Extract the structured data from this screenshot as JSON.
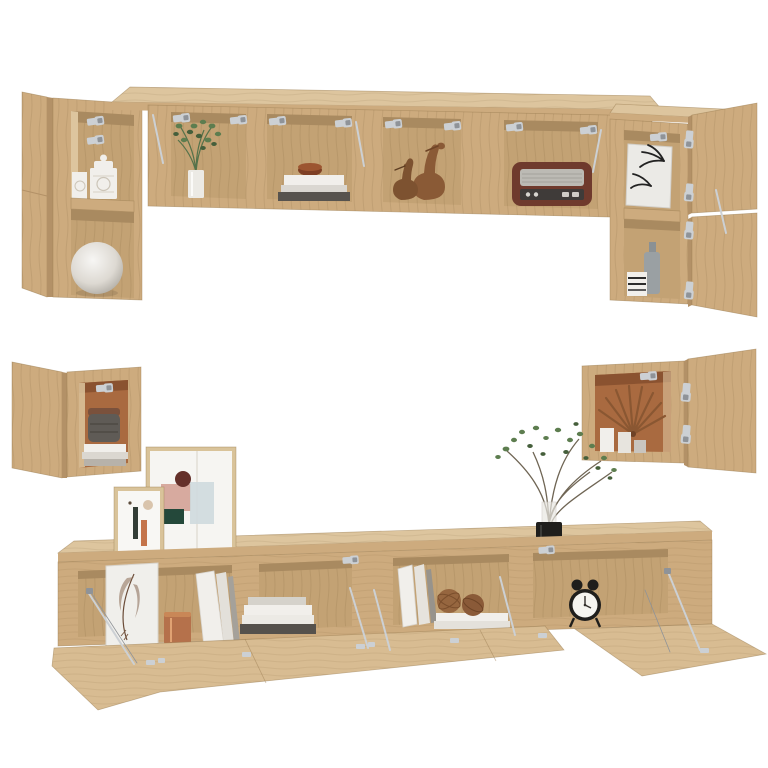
{
  "scene": {
    "description": "Product photo of a six-piece wall-mounted TV cabinet set in sonoma oak with open flap doors, silver hinges and lid stays, styled with decorative accessories, on a plain white background",
    "set_pieces": [
      {
        "name": "top-left-wall-cabinet",
        "decor": [
          "patterned-ceramic-jars",
          "white-sphere-vase"
        ]
      },
      {
        "name": "top-long-wall-cabinet",
        "decor": [
          "green-plant-in-vase",
          "book-stack-with-bowl",
          "wooden-bird-figurines",
          "vintage-radio"
        ]
      },
      {
        "name": "top-right-wall-cabinet",
        "decor": [
          "palm-leaf-print",
          "grey-bottle-vase",
          "striped-box"
        ]
      },
      {
        "name": "mid-left-wall-cube-cabinet",
        "decor": [
          "woven-basket",
          "magazine-stack"
        ]
      },
      {
        "name": "mid-right-wall-cube-cabinet",
        "decor": [
          "dried-palm-fan",
          "white-vases"
        ]
      },
      {
        "name": "tv-bench",
        "decor_on_top": [
          "abstract-art-frame-large",
          "abstract-art-frame-small",
          "plant-in-black-pot"
        ],
        "decor_inside": [
          "feather-print-panel",
          "copper-pot",
          "white-binders",
          "horizontal-book-stack",
          "leaning-books",
          "rattan-balls-on-books",
          "twin-bell-alarm-clock"
        ]
      }
    ],
    "hardware": [
      "silver-flap-hinges",
      "silver-lid-stays"
    ]
  },
  "palette": {
    "background": "#ffffff",
    "wood_front": "#cdab7e",
    "wood_top": "#ddc59e",
    "wood_side": "#b39167",
    "wood_flap": "#d8bc92",
    "wood_interior": "#c3a274",
    "wood_interior_dark": "#a98a60",
    "wood_edge": "#9b7d52",
    "terracotta": "#a96a40",
    "terracotta_dark": "#8a5230",
    "metal": "#ccd0d4",
    "metal_dark": "#8f9398",
    "white_item": "#f1efeb",
    "grey_item": "#c7c3bc",
    "dark_item": "#46423e",
    "copper": "#b5714b",
    "plant_green": "#5d7d4f",
    "plant_green_dark": "#455f3b",
    "radio_body": "#6f3a2d",
    "radio_grille": "#bcbab4",
    "basket_grey": "#5f5b56",
    "rattan": "#96663f",
    "black_item": "#1f1e1c",
    "art_pink": "#d7aa9f",
    "art_teal": "#24483a",
    "art_bluegrey": "#ced9dd",
    "art_brown": "#64302a",
    "art_orange": "#c4744a",
    "frame_wood": "#d9c39a"
  }
}
